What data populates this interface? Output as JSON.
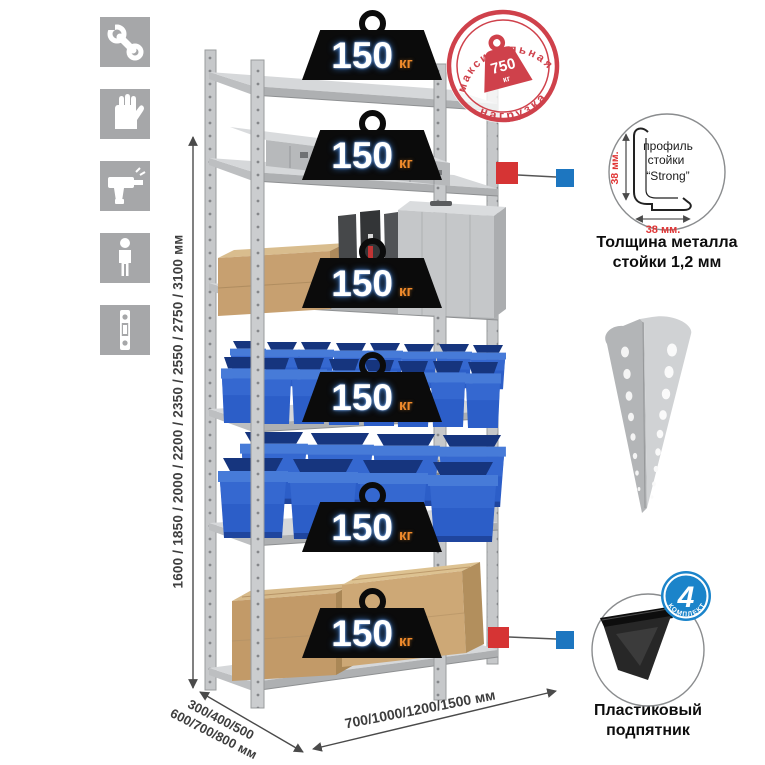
{
  "page": {
    "background": "#ffffff"
  },
  "left_icons": [
    {
      "name": "wrench"
    },
    {
      "name": "gloves"
    },
    {
      "name": "drill"
    },
    {
      "name": "person"
    },
    {
      "name": "upright-profile"
    }
  ],
  "rack": {
    "shelf_count": 6,
    "shelf_load": {
      "value": "150",
      "unit": "кг"
    },
    "colors": {
      "metal": "#c6c8ca",
      "bin_blue": "#2c5ec8",
      "cardboard": "#c7a273"
    }
  },
  "max_load_stamp": {
    "arc_top": "максимальная",
    "arc_bottom": "нагрузка",
    "value": "750",
    "unit": "кг",
    "color": "#cf414b"
  },
  "dimensions": {
    "height": "1600 / 1850 / 2000 / 2200 / 2350 / 2550 / 2750 / 3100 мм",
    "depth_line1": "300/400/500",
    "depth_line2": "600/700/800 мм",
    "width": "700/1000/1200/1500 мм"
  },
  "profile_callout": {
    "label_line1": "профиль",
    "label_line2": "стойки",
    "label_line3": "“Strong”",
    "dim_vertical": "38 мм.",
    "dim_horizontal": "38 мм.",
    "caption_line1": "Толщина металла",
    "caption_line2": "стойки 1,2 мм"
  },
  "foot_callout": {
    "badge_value": "4",
    "badge_text": "В КОМПЛЕКТЕ",
    "caption_line1": "Пластиковый",
    "caption_line2": "подпятник"
  }
}
